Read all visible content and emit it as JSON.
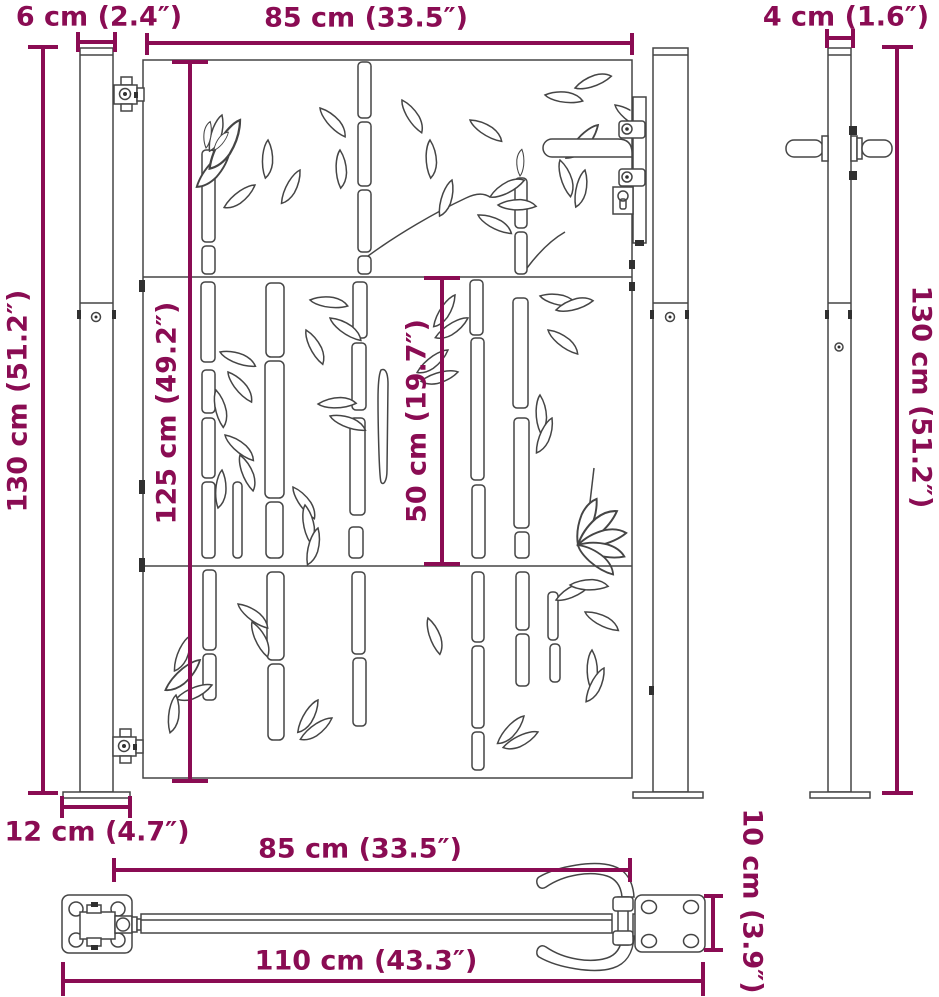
{
  "drawing": {
    "title": "Garden gate with bamboo design – dimension drawing",
    "accent_color": "#8a0c53",
    "outline_color": "#454545",
    "views": [
      "front view",
      "side view",
      "bottom view"
    ]
  },
  "labels": {
    "post_width_front": "6 cm (2.4″)",
    "gate_width_top": "85 cm (33.5″)",
    "post_width_side": "4 cm (1.6″)",
    "post_height_left": "130 cm (51.2″)",
    "gate_height": "125 cm (49.2″)",
    "panel_height": "50 cm (19.7″)",
    "post_height_right": "130 cm (51.2″)",
    "base_plate_width": "12 cm (4.7″)",
    "gate_width_bottom": "85 cm (33.5″)",
    "overall_width": "110 cm (43.3″)",
    "base_plate_depth": "10 cm (3.9″)"
  }
}
